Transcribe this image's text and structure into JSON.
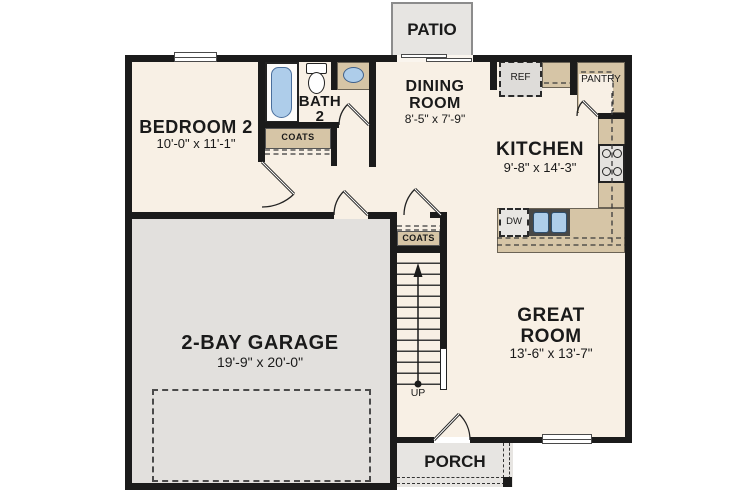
{
  "floorplan": {
    "rooms": [
      {
        "id": "bedroom2",
        "name": "BEDROOM 2",
        "dims": "10'-0\" x 11'-1\""
      },
      {
        "id": "bath2",
        "name": "BATH 2",
        "dims": ""
      },
      {
        "id": "dining",
        "name": "DINING ROOM",
        "dims": "8'-5\" x 7'-9\""
      },
      {
        "id": "kitchen",
        "name": "KITCHEN",
        "dims": "9'-8\" x 14'-3\""
      },
      {
        "id": "greatroom",
        "name": "GREAT ROOM",
        "dims": "13'-6\" x 13'-7\""
      },
      {
        "id": "garage",
        "name": "2-BAY GARAGE",
        "dims": "19'-9\" x 20'-0\""
      }
    ],
    "outdoor": {
      "patio": "PATIO",
      "porch": "PORCH"
    },
    "features": {
      "coats": "COATS",
      "ref": "REF",
      "pantry": "PANTRY",
      "dishwasher": "DW",
      "stairs_up": "UP"
    }
  },
  "colors": {
    "floor": "#f8f0e5",
    "garage": "#e2e0dd",
    "outdoor": "#e7e5e2",
    "counter": "#d6c5a6",
    "wall": "#1b1b1b",
    "fixture": "#aecdea",
    "fixtureBorder": "#3f618c",
    "dash": "#3a3a3a"
  }
}
